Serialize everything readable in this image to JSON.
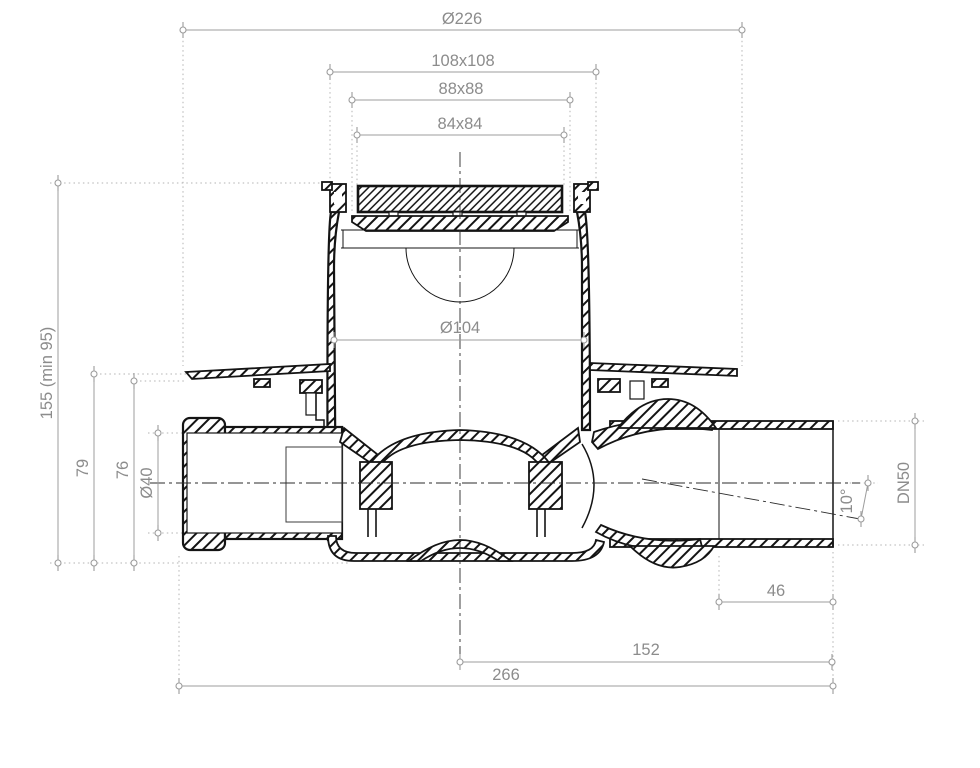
{
  "document": {
    "type": "technical-drawing",
    "subject": "Floor drain with side inlet and horizontal outlet - dimensioned sectional view",
    "background_color": "#ffffff",
    "drawing_line_color": "#141414",
    "dimension_color": "#8c8c8c"
  },
  "dimensions": [
    {
      "id": "flange-diameter",
      "label": "Ø226",
      "orientation": "horizontal",
      "location": "top"
    },
    {
      "id": "frame-outer-size",
      "label": "108x108",
      "orientation": "horizontal",
      "location": "top"
    },
    {
      "id": "grate-seat-size",
      "label": "88x88",
      "orientation": "horizontal",
      "location": "top"
    },
    {
      "id": "grate-size",
      "label": "84x84",
      "orientation": "horizontal",
      "location": "top"
    },
    {
      "id": "body-inner-diameter",
      "label": "Ø104",
      "orientation": "horizontal",
      "location": "middle"
    },
    {
      "id": "total-height",
      "label": "155 (min 95)",
      "orientation": "vertical",
      "location": "left"
    },
    {
      "id": "flange-top-height",
      "label": "79",
      "orientation": "vertical",
      "location": "left"
    },
    {
      "id": "flange-underside-height",
      "label": "76",
      "orientation": "vertical",
      "location": "left"
    },
    {
      "id": "inlet-diameter",
      "label": "Ø40",
      "orientation": "vertical",
      "location": "left"
    },
    {
      "id": "outlet-nominal-size",
      "label": "DN50",
      "orientation": "vertical",
      "location": "right"
    },
    {
      "id": "outlet-slope-angle",
      "label": "10°",
      "orientation": "angular",
      "location": "right"
    },
    {
      "id": "outlet-socket-length",
      "label": "46",
      "orientation": "horizontal",
      "location": "bottom"
    },
    {
      "id": "centre-to-outlet-end",
      "label": "152",
      "orientation": "horizontal",
      "location": "bottom"
    },
    {
      "id": "total-length",
      "label": "266",
      "orientation": "horizontal",
      "location": "bottom"
    }
  ]
}
